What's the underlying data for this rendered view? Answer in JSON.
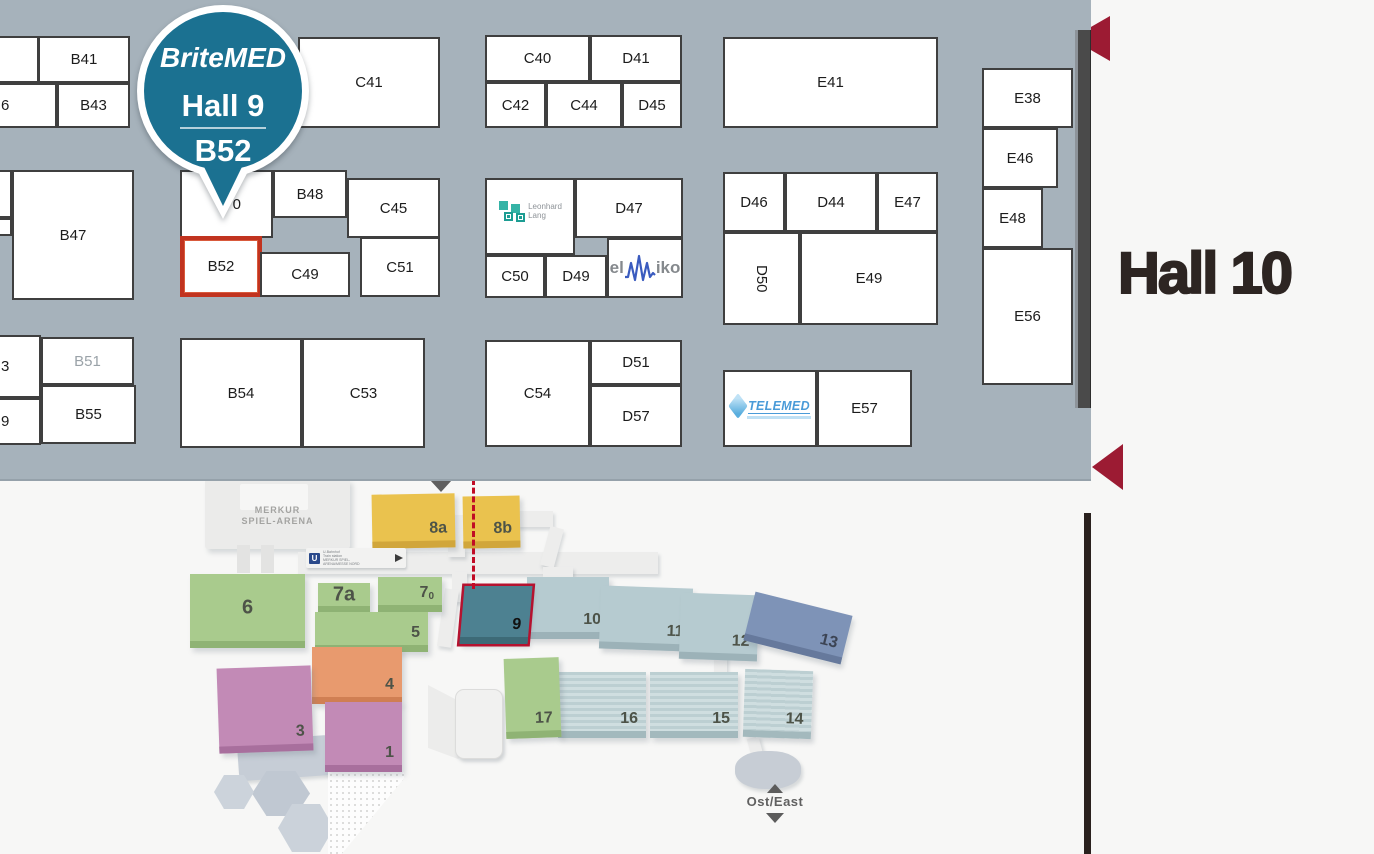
{
  "pin": {
    "brand": "BriteMED",
    "hall": "Hall 9",
    "booth": "B52",
    "color": "#1b7191"
  },
  "hall10": {
    "label": "Hall 10"
  },
  "hall_map": {
    "background": "#a6b2bb",
    "booth_border": "#3f3f3f",
    "highlight_border": "#c1331f",
    "arrow_color": "#9c1b33",
    "booths": [
      {
        "name": "cut-booth-top-left",
        "label": "",
        "x": -3,
        "y": 36,
        "w": 42,
        "h": 47
      },
      {
        "label": "B41",
        "x": 38,
        "y": 36,
        "w": 92,
        "h": 47
      },
      {
        "name": "cut-booth-6",
        "label": "6",
        "x": -3,
        "y": 83,
        "w": 60,
        "h": 45,
        "mods": [
          "frag"
        ]
      },
      {
        "label": "B43",
        "x": 57,
        "y": 83,
        "w": 73,
        "h": 45
      },
      {
        "label": "C41",
        "x": 298,
        "y": 37,
        "w": 142,
        "h": 91
      },
      {
        "label": "C40",
        "x": 485,
        "y": 35,
        "w": 105,
        "h": 47
      },
      {
        "label": "D41",
        "x": 590,
        "y": 35,
        "w": 92,
        "h": 47
      },
      {
        "label": "C42",
        "x": 485,
        "y": 82,
        "w": 61,
        "h": 46
      },
      {
        "label": "C44",
        "x": 546,
        "y": 82,
        "w": 76,
        "h": 46
      },
      {
        "label": "D45",
        "x": 622,
        "y": 82,
        "w": 60,
        "h": 46
      },
      {
        "label": "E41",
        "x": 723,
        "y": 37,
        "w": 215,
        "h": 91
      },
      {
        "label": "E38",
        "x": 982,
        "y": 68,
        "w": 91,
        "h": 60
      },
      {
        "label": "E46",
        "x": 982,
        "y": 128,
        "w": 76,
        "h": 60
      },
      {
        "label": "E48",
        "x": 982,
        "y": 188,
        "w": 61,
        "h": 60
      },
      {
        "label": "E56",
        "x": 982,
        "y": 248,
        "w": 91,
        "h": 137
      },
      {
        "name": "cut-booth-left-a",
        "label": "",
        "x": -3,
        "y": 170,
        "w": 15,
        "h": 48
      },
      {
        "name": "cut-booth-left-b",
        "label": "",
        "x": -3,
        "y": 218,
        "w": 15,
        "h": 18
      },
      {
        "label": "B47",
        "x": 12,
        "y": 170,
        "w": 122,
        "h": 130
      },
      {
        "name": "booth-under-pin-0",
        "label": "0",
        "x": 180,
        "y": 170,
        "w": 93,
        "h": 68,
        "mods": [
          "alignRight"
        ]
      },
      {
        "label": "B48",
        "x": 273,
        "y": 170,
        "w": 74,
        "h": 48
      },
      {
        "label": "C45",
        "x": 347,
        "y": 178,
        "w": 93,
        "h": 60
      },
      {
        "label": "B52",
        "x": 180,
        "y": 236,
        "w": 82,
        "h": 61,
        "mods": [
          "highlight"
        ]
      },
      {
        "label": "C49",
        "x": 260,
        "y": 252,
        "w": 90,
        "h": 45
      },
      {
        "label": "C51",
        "x": 360,
        "y": 237,
        "w": 80,
        "h": 60
      },
      {
        "name": "booth-leonhard-lang",
        "logo": "leonhard_lang",
        "x": 485,
        "y": 178,
        "w": 90,
        "h": 77
      },
      {
        "label": "D47",
        "x": 575,
        "y": 178,
        "w": 108,
        "h": 60
      },
      {
        "label": "C50",
        "x": 485,
        "y": 255,
        "w": 60,
        "h": 43
      },
      {
        "label": "D49",
        "x": 545,
        "y": 255,
        "w": 62,
        "h": 43
      },
      {
        "name": "booth-elmiko",
        "logo": "elmiko",
        "x": 607,
        "y": 238,
        "w": 76,
        "h": 60
      },
      {
        "label": "D46",
        "x": 723,
        "y": 172,
        "w": 62,
        "h": 60
      },
      {
        "label": "D44",
        "x": 785,
        "y": 172,
        "w": 92,
        "h": 60
      },
      {
        "label": "E47",
        "x": 877,
        "y": 172,
        "w": 61,
        "h": 60
      },
      {
        "label": "D50",
        "x": 723,
        "y": 232,
        "w": 77,
        "h": 93,
        "mods": [
          "vertical"
        ]
      },
      {
        "label": "E49",
        "x": 800,
        "y": 232,
        "w": 138,
        "h": 93
      },
      {
        "name": "cut-booth-3",
        "label": "3",
        "x": -3,
        "y": 335,
        "w": 44,
        "h": 63,
        "mods": [
          "frag"
        ]
      },
      {
        "name": "cut-booth-9",
        "label": "9",
        "x": -3,
        "y": 398,
        "w": 44,
        "h": 47,
        "mods": [
          "frag"
        ]
      },
      {
        "label": "B51",
        "x": 41,
        "y": 337,
        "w": 93,
        "h": 48,
        "mods": [
          "muted"
        ]
      },
      {
        "label": "B55",
        "x": 41,
        "y": 385,
        "w": 95,
        "h": 59
      },
      {
        "label": "B54",
        "x": 180,
        "y": 338,
        "w": 122,
        "h": 110
      },
      {
        "label": "C53",
        "x": 302,
        "y": 338,
        "w": 123,
        "h": 110
      },
      {
        "label": "C54",
        "x": 485,
        "y": 340,
        "w": 105,
        "h": 107
      },
      {
        "label": "D51",
        "x": 590,
        "y": 340,
        "w": 92,
        "h": 45
      },
      {
        "label": "D57",
        "x": 590,
        "y": 385,
        "w": 92,
        "h": 62
      },
      {
        "name": "booth-telemed",
        "logo": "telemed",
        "x": 723,
        "y": 370,
        "w": 94,
        "h": 77
      },
      {
        "label": "E57",
        "x": 817,
        "y": 370,
        "w": 95,
        "h": 77
      }
    ],
    "logos": {
      "leonhard_lang": {
        "line1": "Leonhard",
        "line2": "Lang"
      },
      "elmiko": {
        "prefix": "el",
        "suffix": "iko"
      },
      "telemed": {
        "text": "TELEMED"
      }
    }
  },
  "overview": {
    "highlight_color": "#b5122f",
    "arena_line1": "MERKUR",
    "arena_line2": "SPIEL-ARENA",
    "east_label": "Ost/East",
    "u_sign": "U",
    "u_lines": [
      "U-Bahnhof",
      "Train station",
      "MERKUR SPIEL-",
      "ARENA/MESSE NORD"
    ],
    "halls": [
      {
        "id": "8a",
        "label": "8a",
        "x": 372,
        "y": 15,
        "w": 83,
        "h": 54,
        "color": "#eac24e",
        "side": "#d1a63b",
        "rot": -1
      },
      {
        "id": "8b",
        "label": "8b",
        "x": 463,
        "y": 17,
        "w": 57,
        "h": 52,
        "color": "#eac24e",
        "side": "#d1a63b",
        "rot": -1
      },
      {
        "id": "6",
        "label": "6",
        "x": 190,
        "y": 95,
        "w": 115,
        "h": 74,
        "color": "#a9cb8d",
        "side": "#8fb374",
        "center": true
      },
      {
        "id": "7a",
        "label": "7a",
        "x": 318,
        "y": 104,
        "w": 52,
        "h": 30,
        "color": "#a9cb8d",
        "side": "#8fb374",
        "center": true
      },
      {
        "id": "7.0",
        "label": "7",
        "sub": "0",
        "x": 378,
        "y": 98,
        "w": 64,
        "h": 35,
        "color": "#a9cb8d",
        "side": "#8fb374"
      },
      {
        "id": "5",
        "label": "5",
        "x": 315,
        "y": 133,
        "w": 113,
        "h": 40,
        "color": "#a9cb8d",
        "side": "#8fb374"
      },
      {
        "id": "10",
        "label": "10",
        "x": 527,
        "y": 98,
        "w": 82,
        "h": 62,
        "color": "#b6cbd0",
        "side": "#9cb2b8"
      },
      {
        "id": "11",
        "label": "11",
        "x": 600,
        "y": 108,
        "w": 92,
        "h": 63,
        "color": "#b6cbd0",
        "side": "#9cb2b8",
        "rot": 2
      },
      {
        "id": "12",
        "label": "12",
        "x": 680,
        "y": 115,
        "w": 78,
        "h": 66,
        "color": "#b6cbd0",
        "side": "#9cb2b8",
        "rot": 2
      },
      {
        "id": "13",
        "label": "13",
        "x": 748,
        "y": 124,
        "w": 100,
        "h": 50,
        "color": "#7e93b7",
        "side": "#66799c",
        "rot": 14,
        "label_color": "#3c4454"
      },
      {
        "id": "16",
        "label": "16",
        "x": 558,
        "y": 193,
        "w": 88,
        "h": 66,
        "stripes": true,
        "side": "#a3b9bd"
      },
      {
        "id": "15",
        "label": "15",
        "x": 650,
        "y": 193,
        "w": 88,
        "h": 66,
        "stripes": true,
        "side": "#a3b9bd"
      },
      {
        "id": "14",
        "label": "14",
        "x": 744,
        "y": 191,
        "w": 68,
        "h": 68,
        "stripes": true,
        "side": "#a3b9bd",
        "rot": 2
      },
      {
        "id": "17",
        "label": "17",
        "x": 505,
        "y": 179,
        "w": 55,
        "h": 80,
        "color": "#a9cb8d",
        "side": "#8fb374",
        "rot": -2
      },
      {
        "id": "4",
        "label": "4",
        "x": 312,
        "y": 168,
        "w": 90,
        "h": 57,
        "color": "#e89a6e",
        "side": "#d07f53"
      },
      {
        "id": "3",
        "label": "3",
        "x": 218,
        "y": 188,
        "w": 94,
        "h": 85,
        "color": "#c28ab6",
        "side": "#a86f9d",
        "rot": -2
      },
      {
        "id": "1",
        "label": "1",
        "x": 325,
        "y": 223,
        "w": 77,
        "h": 70,
        "color": "#c28ab6",
        "side": "#a86f9d"
      },
      {
        "id": "9",
        "label": "9",
        "x": 462,
        "y": 107,
        "w": 68,
        "h": 58,
        "color": "#4d8191",
        "side": "#3d6a77",
        "skew": -5,
        "highlight": true,
        "label_color": "#111111"
      }
    ]
  }
}
